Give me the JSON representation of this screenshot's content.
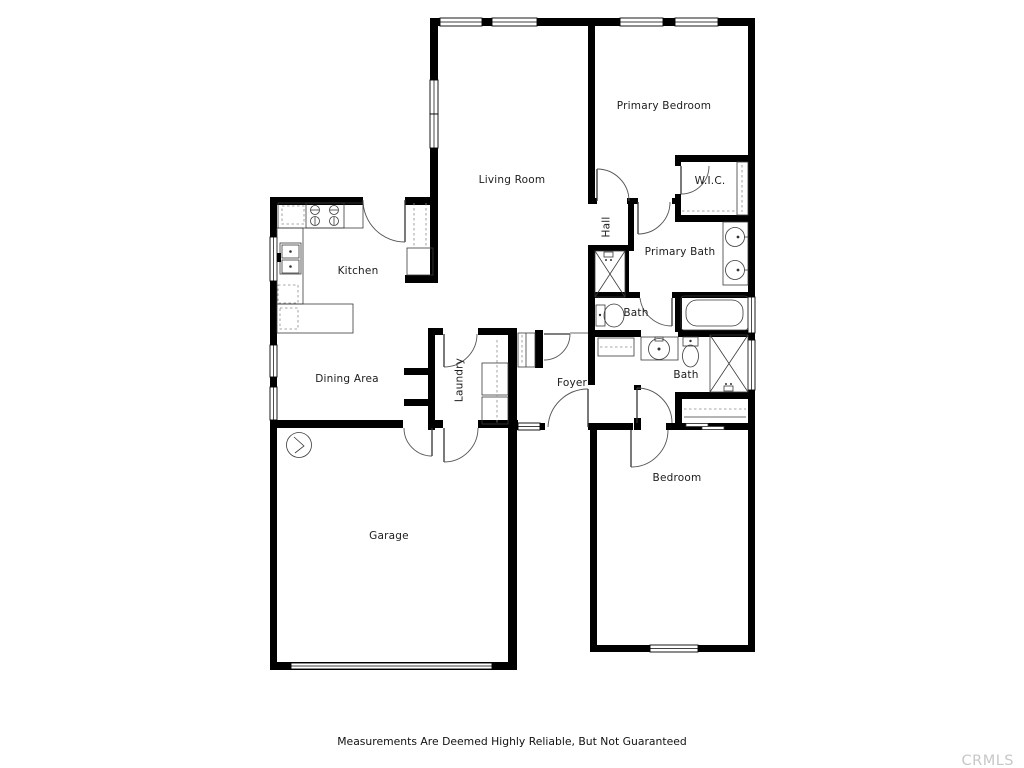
{
  "page": {
    "background": "#ffffff",
    "type": "floor-plan-listing-image"
  },
  "colors": {
    "wall": "#000000",
    "label_text": "#1c1c1c",
    "fixture_stroke": "#3a3a3a",
    "watermark_text": "#c7c7c7"
  },
  "plan": {
    "rooms": {
      "living_room": {
        "label": "Living Room"
      },
      "primary_bedroom": {
        "label": "Primary Bedroom"
      },
      "wic": {
        "label": "W.I.C."
      },
      "hall": {
        "label": "Hall"
      },
      "primary_bath": {
        "label": "Primary Bath"
      },
      "bath_upper": {
        "label": "Bath"
      },
      "bath_lower": {
        "label": "Bath"
      },
      "foyer": {
        "label": "Foyer"
      },
      "laundry": {
        "label": "Laundry"
      },
      "kitchen": {
        "label": "Kitchen"
      },
      "dining_area": {
        "label": "Dining Area"
      },
      "garage": {
        "label": "Garage"
      },
      "bedroom": {
        "label": "Bedroom"
      }
    },
    "fixtures": [
      "stove",
      "kitchen-sink",
      "dishwasher",
      "pantry-shelves",
      "water-heater",
      "washer-dryer",
      "coat-closet",
      "linen-shelf",
      "toilet",
      "bathtub",
      "shower",
      "vanity-sink",
      "double-vanity",
      "closet-rod",
      "garage-door",
      "windows"
    ]
  },
  "footer": {
    "disclaimer": "Measurements Are Deemed Highly Reliable, But Not Guaranteed",
    "watermark": "CRMLS"
  }
}
